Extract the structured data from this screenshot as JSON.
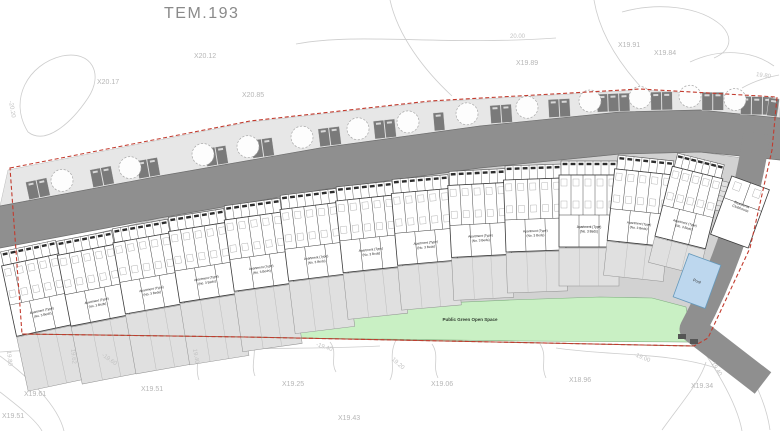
{
  "title": "TEM.193",
  "site": {
    "green_space_label": "Public Green Open Space",
    "pool_label": "Pool",
    "clubhouse_label": [
      "Residents",
      "Clubhouse"
    ],
    "block_label_line1": "Apartment (Type)",
    "block_label_line2": "(No. 3 Beds)"
  },
  "colors": {
    "boundary_red": "#c23b2e",
    "boundary_brown": "#9a5b40",
    "road_gray": "#8f8f8f",
    "verge_gray": "#e7e7e7",
    "plot_gray": "#d2d2d2",
    "garden_gray": "#e0e0e0",
    "parking_dark": "#7a7a7a",
    "green_space": "#c9f0c4",
    "green_edge": "#7fae7f",
    "pool_blue": "#bdd7ee",
    "pool_edge": "#6699bb",
    "contour_gray": "#cdcdcd",
    "building_line": "#3a3a3a"
  },
  "spot_levels": [
    {
      "label": "X20.12",
      "x": 194,
      "y": 53
    },
    {
      "label": "X20.17",
      "x": 97,
      "y": 79
    },
    {
      "label": "X20.85",
      "x": 242,
      "y": 92
    },
    {
      "label": "X19.89",
      "x": 516,
      "y": 60
    },
    {
      "label": "X19.91",
      "x": 618,
      "y": 42
    },
    {
      "label": "X19.84",
      "x": 654,
      "y": 50
    },
    {
      "label": "X19.61",
      "x": 24,
      "y": 391
    },
    {
      "label": "X19.51",
      "x": 141,
      "y": 386
    },
    {
      "label": "X19.25",
      "x": 282,
      "y": 381
    },
    {
      "label": "X19.06",
      "x": 431,
      "y": 381
    },
    {
      "label": "X18.96",
      "x": 569,
      "y": 377
    },
    {
      "label": "X19.34",
      "x": 691,
      "y": 383
    },
    {
      "label": "X19.51",
      "x": 2,
      "y": 413
    },
    {
      "label": "X19.43",
      "x": 338,
      "y": 415
    }
  ],
  "contour_labels": [
    {
      "label": "-20.20",
      "x": 10,
      "y": 98,
      "rot": 80
    },
    {
      "label": "20.00",
      "x": 510,
      "y": 34,
      "rot": 0
    },
    {
      "label": "19.80",
      "x": 756,
      "y": 72,
      "rot": 8
    },
    {
      "label": "19.80",
      "x": 8,
      "y": 348,
      "rot": 84
    },
    {
      "label": "19.62",
      "x": 72,
      "y": 346,
      "rot": 84
    },
    {
      "label": "-19.60",
      "x": 102,
      "y": 352,
      "rot": 35
    },
    {
      "label": "19.40",
      "x": 194,
      "y": 346,
      "rot": 80
    },
    {
      "label": "-19.40",
      "x": 316,
      "y": 342,
      "rot": 18
    },
    {
      "label": "19.20",
      "x": 392,
      "y": 356,
      "rot": 42
    },
    {
      "label": "-19.00",
      "x": 634,
      "y": 352,
      "rot": 22
    },
    {
      "label": "19.40",
      "x": 712,
      "y": 360,
      "rot": 58
    }
  ],
  "blocks": [
    {
      "x": 28,
      "y": 246,
      "rot": -12,
      "w": 56,
      "gh": 55
    },
    {
      "x": 84,
      "y": 236,
      "rot": -11,
      "w": 56,
      "gh": 58
    },
    {
      "x": 140,
      "y": 224,
      "rot": -10,
      "w": 56,
      "gh": 60
    },
    {
      "x": 196,
      "y": 213,
      "rot": -9,
      "w": 56,
      "gh": 62
    },
    {
      "x": 252,
      "y": 202,
      "rot": -8,
      "w": 56,
      "gh": 60
    },
    {
      "x": 308,
      "y": 192,
      "rot": -7,
      "w": 56,
      "gh": 52
    },
    {
      "x": 364,
      "y": 184,
      "rot": -6,
      "w": 56,
      "gh": 46
    },
    {
      "x": 420,
      "y": 177,
      "rot": -5,
      "w": 56,
      "gh": 44
    },
    {
      "x": 477,
      "y": 170,
      "rot": -3,
      "w": 56,
      "gh": 42
    },
    {
      "x": 533,
      "y": 165,
      "rot": -2,
      "w": 56,
      "gh": 40
    },
    {
      "x": 589,
      "y": 161,
      "rot": 0,
      "w": 56,
      "gh": 38
    },
    {
      "x": 646,
      "y": 158,
      "rot": 6,
      "w": 56,
      "gh": 34
    },
    {
      "x": 701,
      "y": 159,
      "rot": 14,
      "w": 48,
      "gh": 26
    }
  ]
}
